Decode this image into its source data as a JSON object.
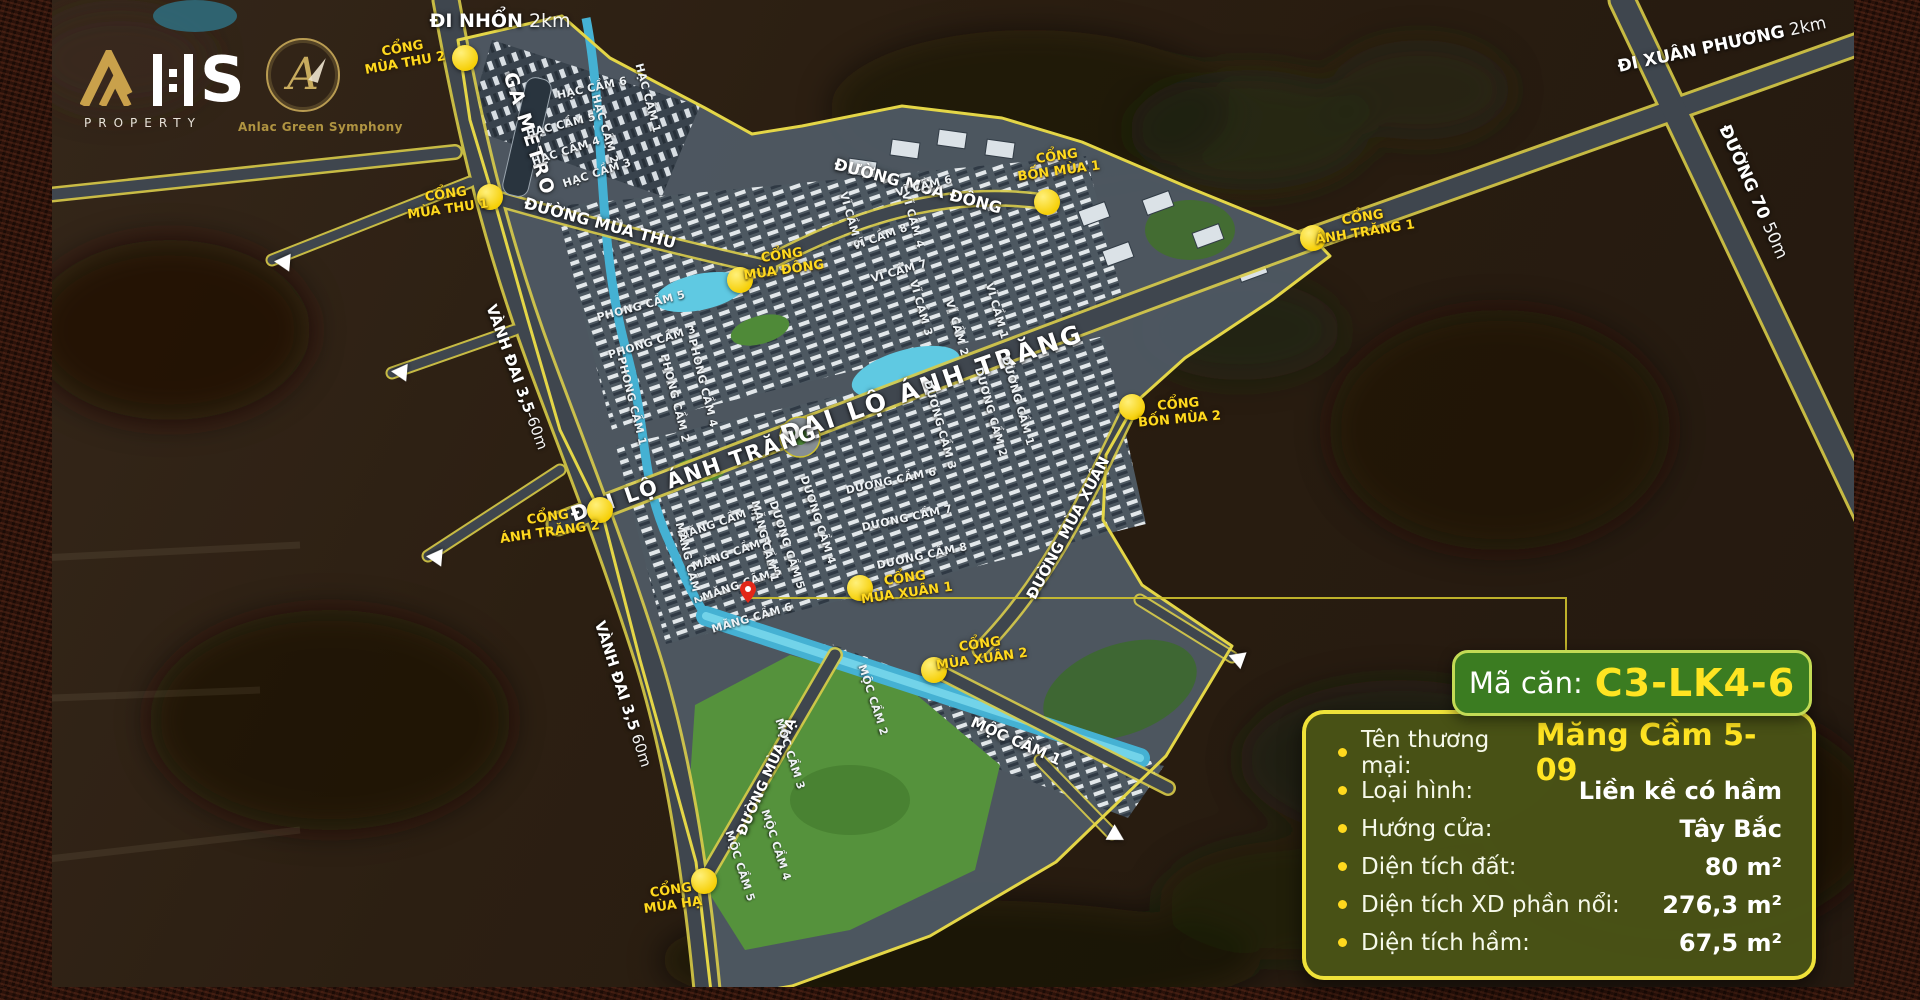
{
  "branding": {
    "logo_s": "S",
    "logo_sub": "PROPERTY",
    "project_name": "Anlac Green Symphony",
    "project_monogram": "A"
  },
  "panel": {
    "title_label": "Mã căn:",
    "title_value": "C3-LK4-6",
    "rows": [
      {
        "label": "Tên thương mại:",
        "value": "Măng Cầm 5-09",
        "highlight": true
      },
      {
        "label": "Loại hình:",
        "value": "Liền kề có hầm"
      },
      {
        "label": "Hướng cửa:",
        "value": "Tây Bắc"
      },
      {
        "label": "Diện tích đất:",
        "value": "80 m²"
      },
      {
        "label": "Diện tích XD phần nổi:",
        "value": "276,3 m²"
      },
      {
        "label": "Diện tích hầm:",
        "value": "67,5 m²"
      }
    ]
  },
  "map": {
    "road_labels": [
      {
        "text": "ĐI NHỔN",
        "suffix": " 2km",
        "x": 500,
        "y": 21,
        "rot": 0,
        "size": 19
      },
      {
        "text": "GA METRO",
        "x": 529,
        "y": 134,
        "rot": 72,
        "size": 19,
        "ls": 2
      },
      {
        "text": "ĐƯỜNG MÙA THU",
        "x": 600,
        "y": 223,
        "rot": 15,
        "size": 16
      },
      {
        "text": "ĐƯỜNG MÙA ĐÔNG",
        "x": 918,
        "y": 186,
        "rot": 15,
        "size": 16
      },
      {
        "text": "ĐẠI LỘ ÁNH TRĂNG",
        "x": 932,
        "y": 384,
        "rot": -19,
        "size": 25,
        "ls": 3
      },
      {
        "text": "ĐẠI LỘ ÁNH TRĂNG",
        "x": 694,
        "y": 473,
        "rot": -19,
        "size": 21,
        "ls": 2
      },
      {
        "text": "VÀNH ĐAI 3,5",
        "suffix": "-60m",
        "x": 517,
        "y": 377,
        "rot": 70,
        "size": 15
      },
      {
        "text": "VÀNH ĐAI 3,5",
        "suffix": " 60m",
        "x": 623,
        "y": 694,
        "rot": 72,
        "size": 15
      },
      {
        "text": "ĐƯỜNG MÙA XUÂN",
        "x": 1068,
        "y": 528,
        "rot": -62,
        "size": 15
      },
      {
        "text": "ĐƯỜNG MÙA HẠ",
        "x": 767,
        "y": 777,
        "rot": -66,
        "size": 14
      },
      {
        "text": "MỘC CẦM 1",
        "x": 1016,
        "y": 741,
        "rot": 24,
        "size": 15
      },
      {
        "text": "ĐI XUÂN PHƯƠNG",
        "suffix": " 2km",
        "x": 1722,
        "y": 45,
        "rot": -12,
        "size": 17
      },
      {
        "text": "ĐƯỜNG 70",
        "suffix": " 50m",
        "x": 1753,
        "y": 192,
        "rot": 66,
        "size": 17
      }
    ],
    "gates": [
      {
        "lines": [
          "CỔNG",
          "MÙA THU 2"
        ],
        "x": 404,
        "y": 57,
        "rot": -10,
        "mx": 465,
        "my": 58
      },
      {
        "lines": [
          "CỔNG",
          "MÙA THU 1"
        ],
        "x": 447,
        "y": 203,
        "rot": -8,
        "mx": 490,
        "my": 197
      },
      {
        "lines": [
          "CỔNG",
          "MÙA ĐÔNG"
        ],
        "x": 783,
        "y": 264,
        "rot": -8,
        "mx": 740,
        "my": 280
      },
      {
        "lines": [
          "CỔNG",
          "BỐN MÙA 1"
        ],
        "x": 1058,
        "y": 165,
        "rot": -8,
        "mx": 1047,
        "my": 202
      },
      {
        "lines": [
          "CỔNG",
          "ÁNH TRĂNG 1"
        ],
        "x": 1364,
        "y": 226,
        "rot": -9,
        "mx": 1313,
        "my": 238
      },
      {
        "lines": [
          "CỔNG",
          "BỐN MÙA 2"
        ],
        "x": 1179,
        "y": 413,
        "rot": -5,
        "mx": 1132,
        "my": 407
      },
      {
        "lines": [
          "CỔNG",
          "ÁNH TRĂNG 2"
        ],
        "x": 549,
        "y": 526,
        "rot": -8,
        "mx": 600,
        "my": 510
      },
      {
        "lines": [
          "CỔNG",
          "MÙA XUÂN 1"
        ],
        "x": 906,
        "y": 587,
        "rot": -8,
        "mx": 860,
        "my": 588
      },
      {
        "lines": [
          "CỔNG",
          "MÙA XUÂN 2"
        ],
        "x": 981,
        "y": 653,
        "rot": -8,
        "mx": 934,
        "my": 670
      },
      {
        "lines": [
          "CỔNG",
          "MÙA HẠ"
        ],
        "x": 672,
        "y": 899,
        "rot": -8,
        "mx": 704,
        "my": 881
      }
    ],
    "clusters": [
      {
        "text": "HẠC CẦM 6",
        "x": 592,
        "y": 88,
        "rot": -12
      },
      {
        "text": "HẠC CẦM 5",
        "x": 561,
        "y": 125,
        "rot": -14
      },
      {
        "text": "HẠC CẦM 1",
        "x": 648,
        "y": 98,
        "rot": 75
      },
      {
        "text": "HẠC CẦM 2",
        "x": 605,
        "y": 129,
        "rot": 74
      },
      {
        "text": "HẠC CẦM 4",
        "x": 566,
        "y": 151,
        "rot": -18
      },
      {
        "text": "HẠC CẦM 3",
        "x": 597,
        "y": 173,
        "rot": -18
      },
      {
        "text": "PHONG CẦM 5",
        "x": 641,
        "y": 306,
        "rot": -15
      },
      {
        "text": "PHONG CẦM 3",
        "x": 652,
        "y": 342,
        "rot": -17
      },
      {
        "text": "PHONG CẦM 4",
        "x": 703,
        "y": 383,
        "rot": 76
      },
      {
        "text": "PHONG CẦM 2",
        "x": 675,
        "y": 398,
        "rot": 76
      },
      {
        "text": "PHONG CẦM 1",
        "x": 632,
        "y": 401,
        "rot": 76
      },
      {
        "text": "VĨ CẦM 6",
        "x": 924,
        "y": 186,
        "rot": -14
      },
      {
        "text": "VĨ CẦM 8",
        "x": 880,
        "y": 237,
        "rot": -20
      },
      {
        "text": "VĨ CẦM 7",
        "x": 899,
        "y": 271,
        "rot": -16
      },
      {
        "text": "VĨ CẦM 5",
        "x": 851,
        "y": 220,
        "rot": 74
      },
      {
        "text": "VĨ CẦM 4",
        "x": 913,
        "y": 220,
        "rot": 74
      },
      {
        "text": "VĨ CẦM 3",
        "x": 921,
        "y": 308,
        "rot": 74
      },
      {
        "text": "VĨ CẦM 1",
        "x": 997,
        "y": 311,
        "rot": 74
      },
      {
        "text": "VĨ CẦM 2",
        "x": 957,
        "y": 328,
        "rot": 74
      },
      {
        "text": "DƯƠNG CẦM 1",
        "x": 1018,
        "y": 401,
        "rot": 74
      },
      {
        "text": "DƯƠNG CẦM 2",
        "x": 991,
        "y": 412,
        "rot": 74
      },
      {
        "text": "DƯƠNG CẦM 3",
        "x": 940,
        "y": 425,
        "rot": 74
      },
      {
        "text": "DƯƠNG CẦM 6",
        "x": 891,
        "y": 481,
        "rot": -12
      },
      {
        "text": "DƯƠNG CẦM 7",
        "x": 907,
        "y": 518,
        "rot": -12
      },
      {
        "text": "DƯƠNG CẦM 8",
        "x": 922,
        "y": 556,
        "rot": -12
      },
      {
        "text": "DƯƠNG CẦM 4",
        "x": 818,
        "y": 520,
        "rot": 72
      },
      {
        "text": "DƯƠNG CẦM 5",
        "x": 787,
        "y": 545,
        "rot": 72
      },
      {
        "text": "MĂNG CẦM 3",
        "x": 718,
        "y": 523,
        "rot": -19
      },
      {
        "text": "MĂNG CẦM 4",
        "x": 732,
        "y": 553,
        "rot": -19
      },
      {
        "text": "MĂNG CẦM 5",
        "x": 742,
        "y": 584,
        "rot": -19
      },
      {
        "text": "MĂNG CẦM 6",
        "x": 752,
        "y": 618,
        "rot": -16
      },
      {
        "text": "MĂNG CẦM 2",
        "x": 689,
        "y": 563,
        "rot": 76
      },
      {
        "text": "MĂNG CẦM 1",
        "x": 765,
        "y": 541,
        "rot": 76
      },
      {
        "text": "MỘC CẦM 2",
        "x": 873,
        "y": 700,
        "rot": 72
      },
      {
        "text": "MỘC CẦM 3",
        "x": 790,
        "y": 754,
        "rot": 72
      },
      {
        "text": "MỘC CẦM 4",
        "x": 776,
        "y": 845,
        "rot": 72
      },
      {
        "text": "MỘC CẦM 5",
        "x": 740,
        "y": 866,
        "rot": 72
      }
    ],
    "arrows": [
      {
        "x": 282,
        "y": 262,
        "rot": 185
      },
      {
        "x": 399,
        "y": 372,
        "rot": 185
      },
      {
        "x": 434,
        "y": 557,
        "rot": 185
      },
      {
        "x": 1236,
        "y": 658,
        "rot": 200
      },
      {
        "x": 1117,
        "y": 836,
        "rot": 30
      }
    ],
    "pin": {
      "x": 748,
      "y": 601
    },
    "leader": "750,598 1566,598 1566,652"
  },
  "colors": {
    "accent_yellow": "#ffd91e",
    "highlight_yellow": "#ffe422",
    "panel_body_bg": "#4a5316",
    "panel_border": "#efe239",
    "header_bg": "#3b7c21",
    "header_border": "#c3db55",
    "marker_yellow": "#f6cf06",
    "pin_red": "#e22718",
    "boundary_yellow": "#e4d647"
  }
}
